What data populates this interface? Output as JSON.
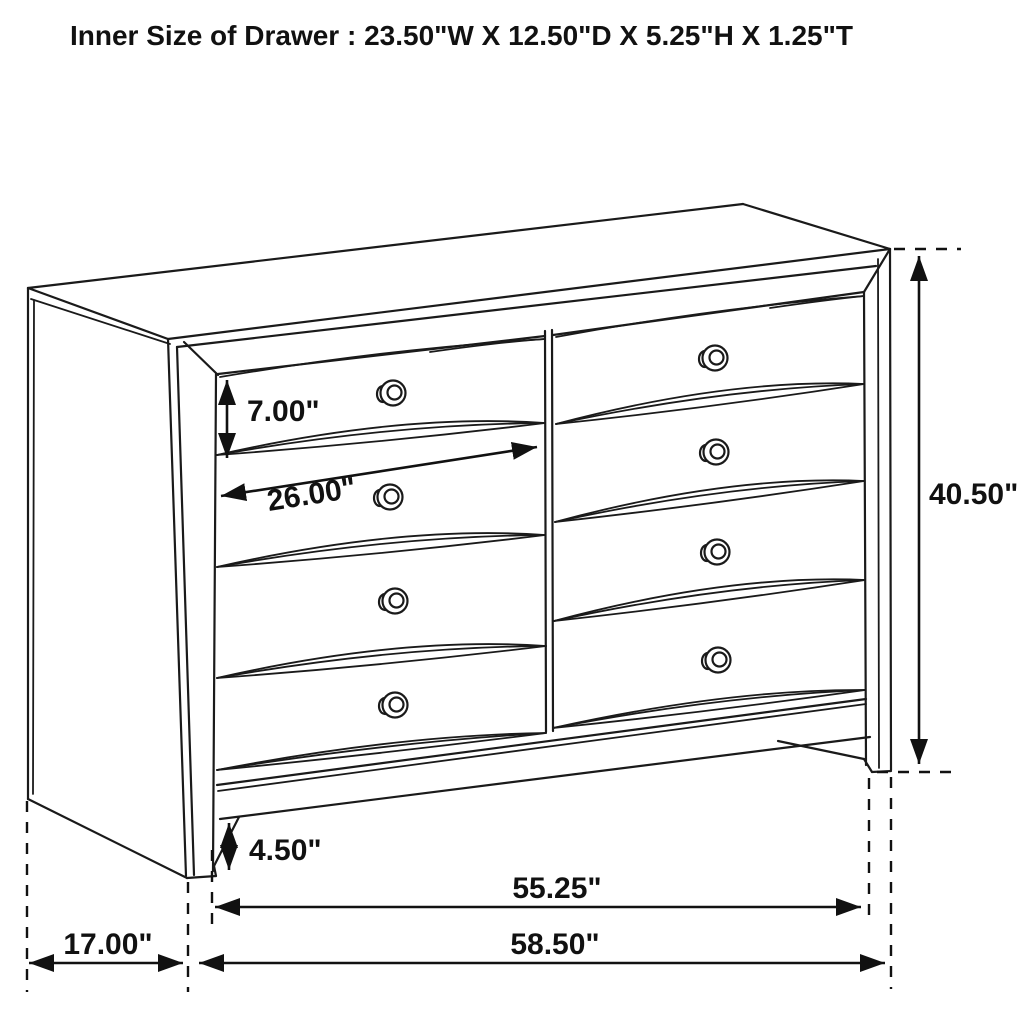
{
  "title": "Inner Size of Drawer : 23.50\"W X 12.50\"D X 5.25\"H X 1.25\"T",
  "drawing": {
    "subject": "Eight-drawer dresser dimensioned technical line drawing",
    "drawer_count": 8,
    "line_color": "#1a1a1a",
    "background": "#ffffff",
    "labels": {
      "drawer_opening_height": "7.00\"",
      "drawer_width": "26.00\"",
      "overall_height": "40.50\"",
      "base_height": "4.50\"",
      "base_width": "55.25\"",
      "overall_width": "58.50\"",
      "depth": "17.00\""
    }
  }
}
